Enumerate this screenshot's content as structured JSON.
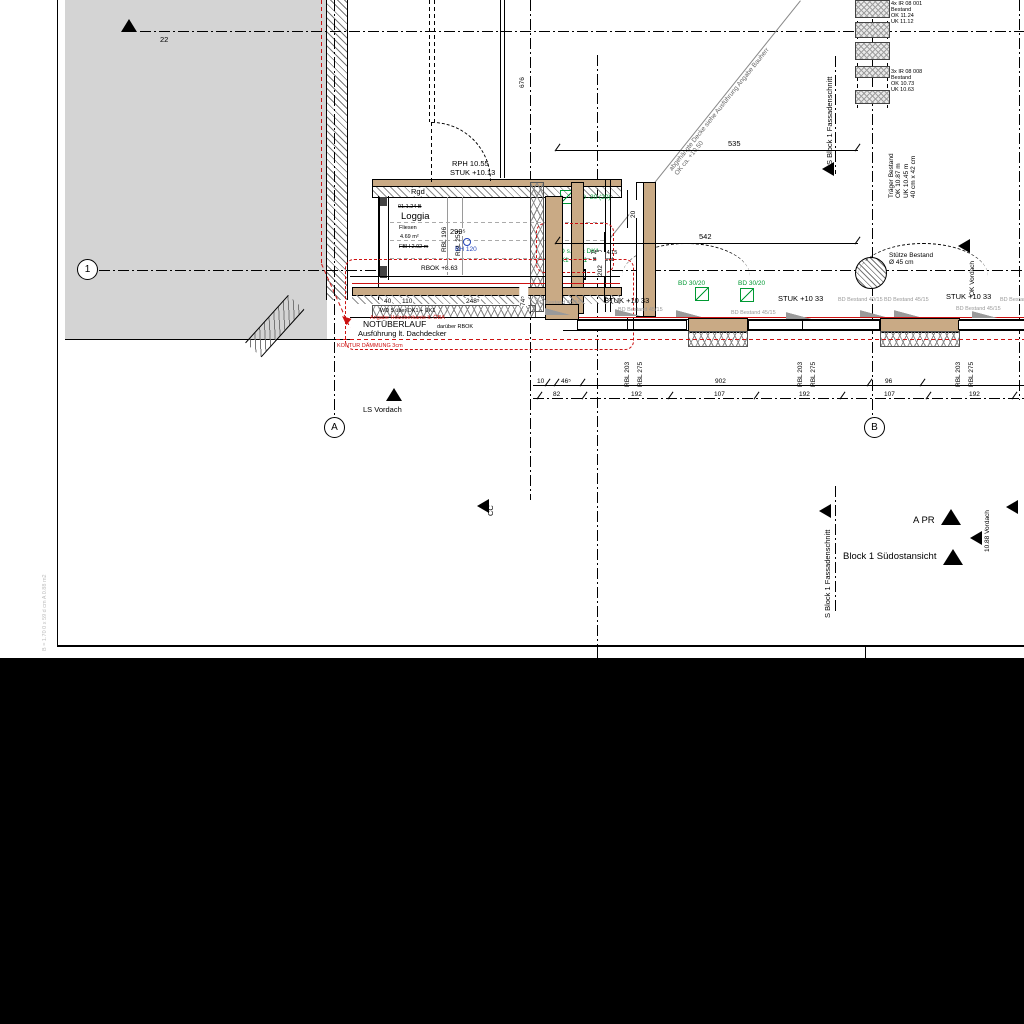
{
  "markers": {
    "grid_1": "1",
    "grid_a": "A",
    "grid_b": "B",
    "dim_22": "22",
    "ls_vordach": "LS Vordach",
    "cc": "CC",
    "fassadenschnitt": "S Block 1 Fassadenschnitt",
    "a_pr": "A PR",
    "block1_suedost": "Block 1 Südostansicht",
    "vordach_1088": "10.88 Vordach",
    "ok_vordach": "OK Vordach"
  },
  "room": {
    "number": "01.1.24 B",
    "name": "Loggia",
    "floor": "Fliesen",
    "area": "4.69 m²",
    "fbh": "FBH 2.92 m",
    "width_dim": "299⁵",
    "rbl_left": "RBL 196",
    "rbl_right": "RBL 253",
    "rbok": "RBOK +8.63",
    "bh": "BH 120",
    "level_rph": "RPH 10.55",
    "level_stuk": "STUK +10.13",
    "rgd": "Rgd"
  },
  "notes": {
    "wd": "WD 5 über DK1 + UK1",
    "holz": "Angabe Holzoberkante lt. ÖBA",
    "notueberlauf": "NOTÜBERLAUF",
    "rbok_small": "darüber RBOK",
    "ausfuehrung": "Ausführung lt. Dachdecker",
    "kontur": "KONTUR DÄMMUNG 3cm",
    "diag1": "abgehängte Decke siehe Ausführung Angabe Bauherr",
    "diag2": "OK ca. +10.50",
    "stuetze1": "Stütze Bestand",
    "stuetze2": "Ø 45 cm",
    "traeger": [
      "Träger Bestand",
      "OK 10.87 m",
      "UK 10.45 m",
      "40 cm x 42 cm"
    ],
    "beams_top": [
      "4x IR 08 001",
      "Bestand",
      "OK 11.24",
      "UK 11.12"
    ],
    "beams_mid": [
      "3x IR 08 008",
      "Bestand",
      "OK 10.73",
      "UK 10.63"
    ],
    "fbd1": "FBD 14/15",
    "fbd2": "Bestand",
    "wd_green1": "WD s.Calc DK1",
    "wd_green2": "DK1 - UK1",
    "bd20": "BD -20 (20)",
    "side_note": "B = 1.70 0 x 59 d cm A 0.88 m2"
  },
  "dims": {
    "d676": "676",
    "d535": "535",
    "d542": "542",
    "d20": "20",
    "d202": "202",
    "d40": "40",
    "d110": "110",
    "d248": "248⁵",
    "d74": "74⁵"
  },
  "repeat": {
    "stuk_labels": {
      "text": "STUK +10 33",
      "pos": [
        [
          604,
          297
        ],
        [
          778,
          295
        ],
        [
          946,
          293
        ]
      ]
    },
    "bd45_labels": {
      "text": "BD Bestand 45/15",
      "pos": [
        [
          536,
          300
        ],
        [
          618,
          307
        ],
        [
          731,
          310
        ],
        [
          884,
          297
        ],
        [
          956,
          306
        ],
        [
          1000,
          297
        ]
      ]
    },
    "bd40_labels": {
      "text": "BD Bestand 40/15",
      "pos": [
        [
          838,
          297
        ]
      ]
    },
    "bd3020_labels": {
      "text": "BD 30/20",
      "pos": [
        [
          678,
          280
        ],
        [
          738,
          280
        ]
      ]
    },
    "rbl_pairs": {
      "texts": [
        "RBL 203",
        "RBL 275"
      ],
      "x": [
        624,
        797,
        955
      ],
      "y": 345
    },
    "dim_top": {
      "y": 378,
      "items": [
        [
          "10",
          536
        ],
        [
          "46⁵",
          560
        ],
        [
          "902",
          714
        ],
        [
          "96",
          884
        ]
      ]
    },
    "dim_bot": {
      "y": 391,
      "items": [
        [
          "82",
          552
        ],
        [
          "192",
          630
        ],
        [
          "107",
          713
        ],
        [
          "192",
          798
        ],
        [
          "107",
          883
        ],
        [
          "192",
          968
        ]
      ]
    },
    "ticks_top": {
      "y": 382,
      "x": [
        543,
        552,
        578,
        865,
        918
      ]
    },
    "ticks_bot": {
      "y": 395,
      "x": [
        535,
        580,
        666,
        752,
        838,
        924,
        1010
      ]
    },
    "sills": {
      "pos": [
        [
          545,
          308
        ],
        [
          615,
          309
        ],
        [
          676,
          310
        ],
        [
          786,
          312
        ],
        [
          860,
          310
        ],
        [
          894,
          310
        ],
        [
          972,
          311
        ]
      ]
    }
  }
}
